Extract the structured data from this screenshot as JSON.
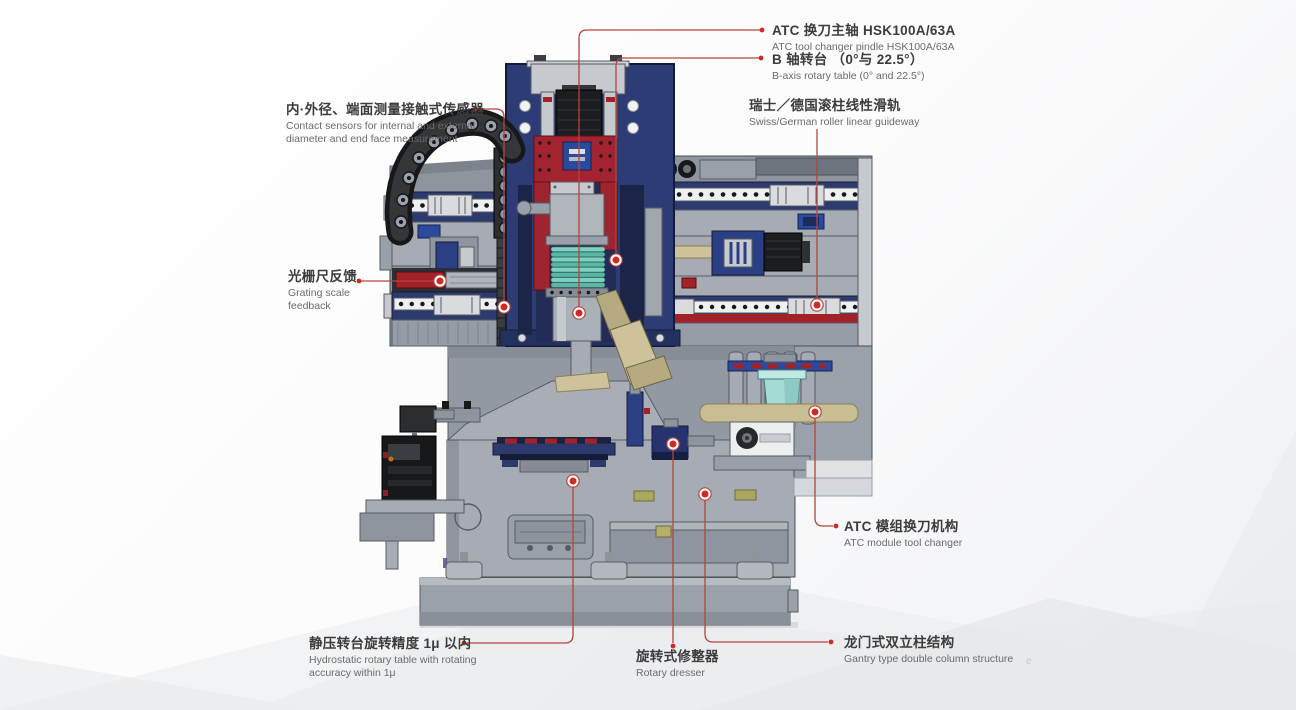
{
  "colors": {
    "callout_red": "#b5443c",
    "dot_red": "#cf2a24",
    "machine_navy": "#2d3c74",
    "machine_gray": "#a6abb4",
    "panel_red": "#a32430",
    "bellows_teal": "#7fd0bf",
    "arm_tan": "#b5aa80",
    "atc_teal": "#a5dbd5",
    "label_cn_color": "#3c3c3c",
    "label_en_color": "#6b6b6b"
  },
  "labels": {
    "atc_spindle": {
      "cn": "ATC 换刀主轴 HSK100A/63A",
      "en": "ATC tool changer pindle HSK100A/63A"
    },
    "b_axis": {
      "cn": "B 轴转台 （0°与 22.5°）",
      "en": "B-axis rotary table (0° and 22.5°)"
    },
    "contact_sensor": {
      "cn": "内·外径、端面测量接触式传感器",
      "en": "Contact sensors for internal and external diameter and end face measurement"
    },
    "linear_guideway": {
      "cn": "瑞士／德国滚柱线性滑轨",
      "en": "Swiss/German roller linear guideway"
    },
    "grating_scale": {
      "cn": "光栅尺反馈",
      "en": "Grating scale feedback"
    },
    "atc_module": {
      "cn": "ATC 模组换刀机构",
      "en": "ATC module tool changer"
    },
    "hydrostatic_table": {
      "cn": "静压转台旋转精度 1μ 以内",
      "en": "Hydrostatic rotary table with rotating accuracy within 1μ"
    },
    "rotary_dresser": {
      "cn": "旋转式修整器",
      "en": "Rotary dresser"
    },
    "gantry_structure": {
      "cn": "龙门式双立柱结构",
      "en": "Gantry type double column structure"
    }
  },
  "watermark": "e"
}
